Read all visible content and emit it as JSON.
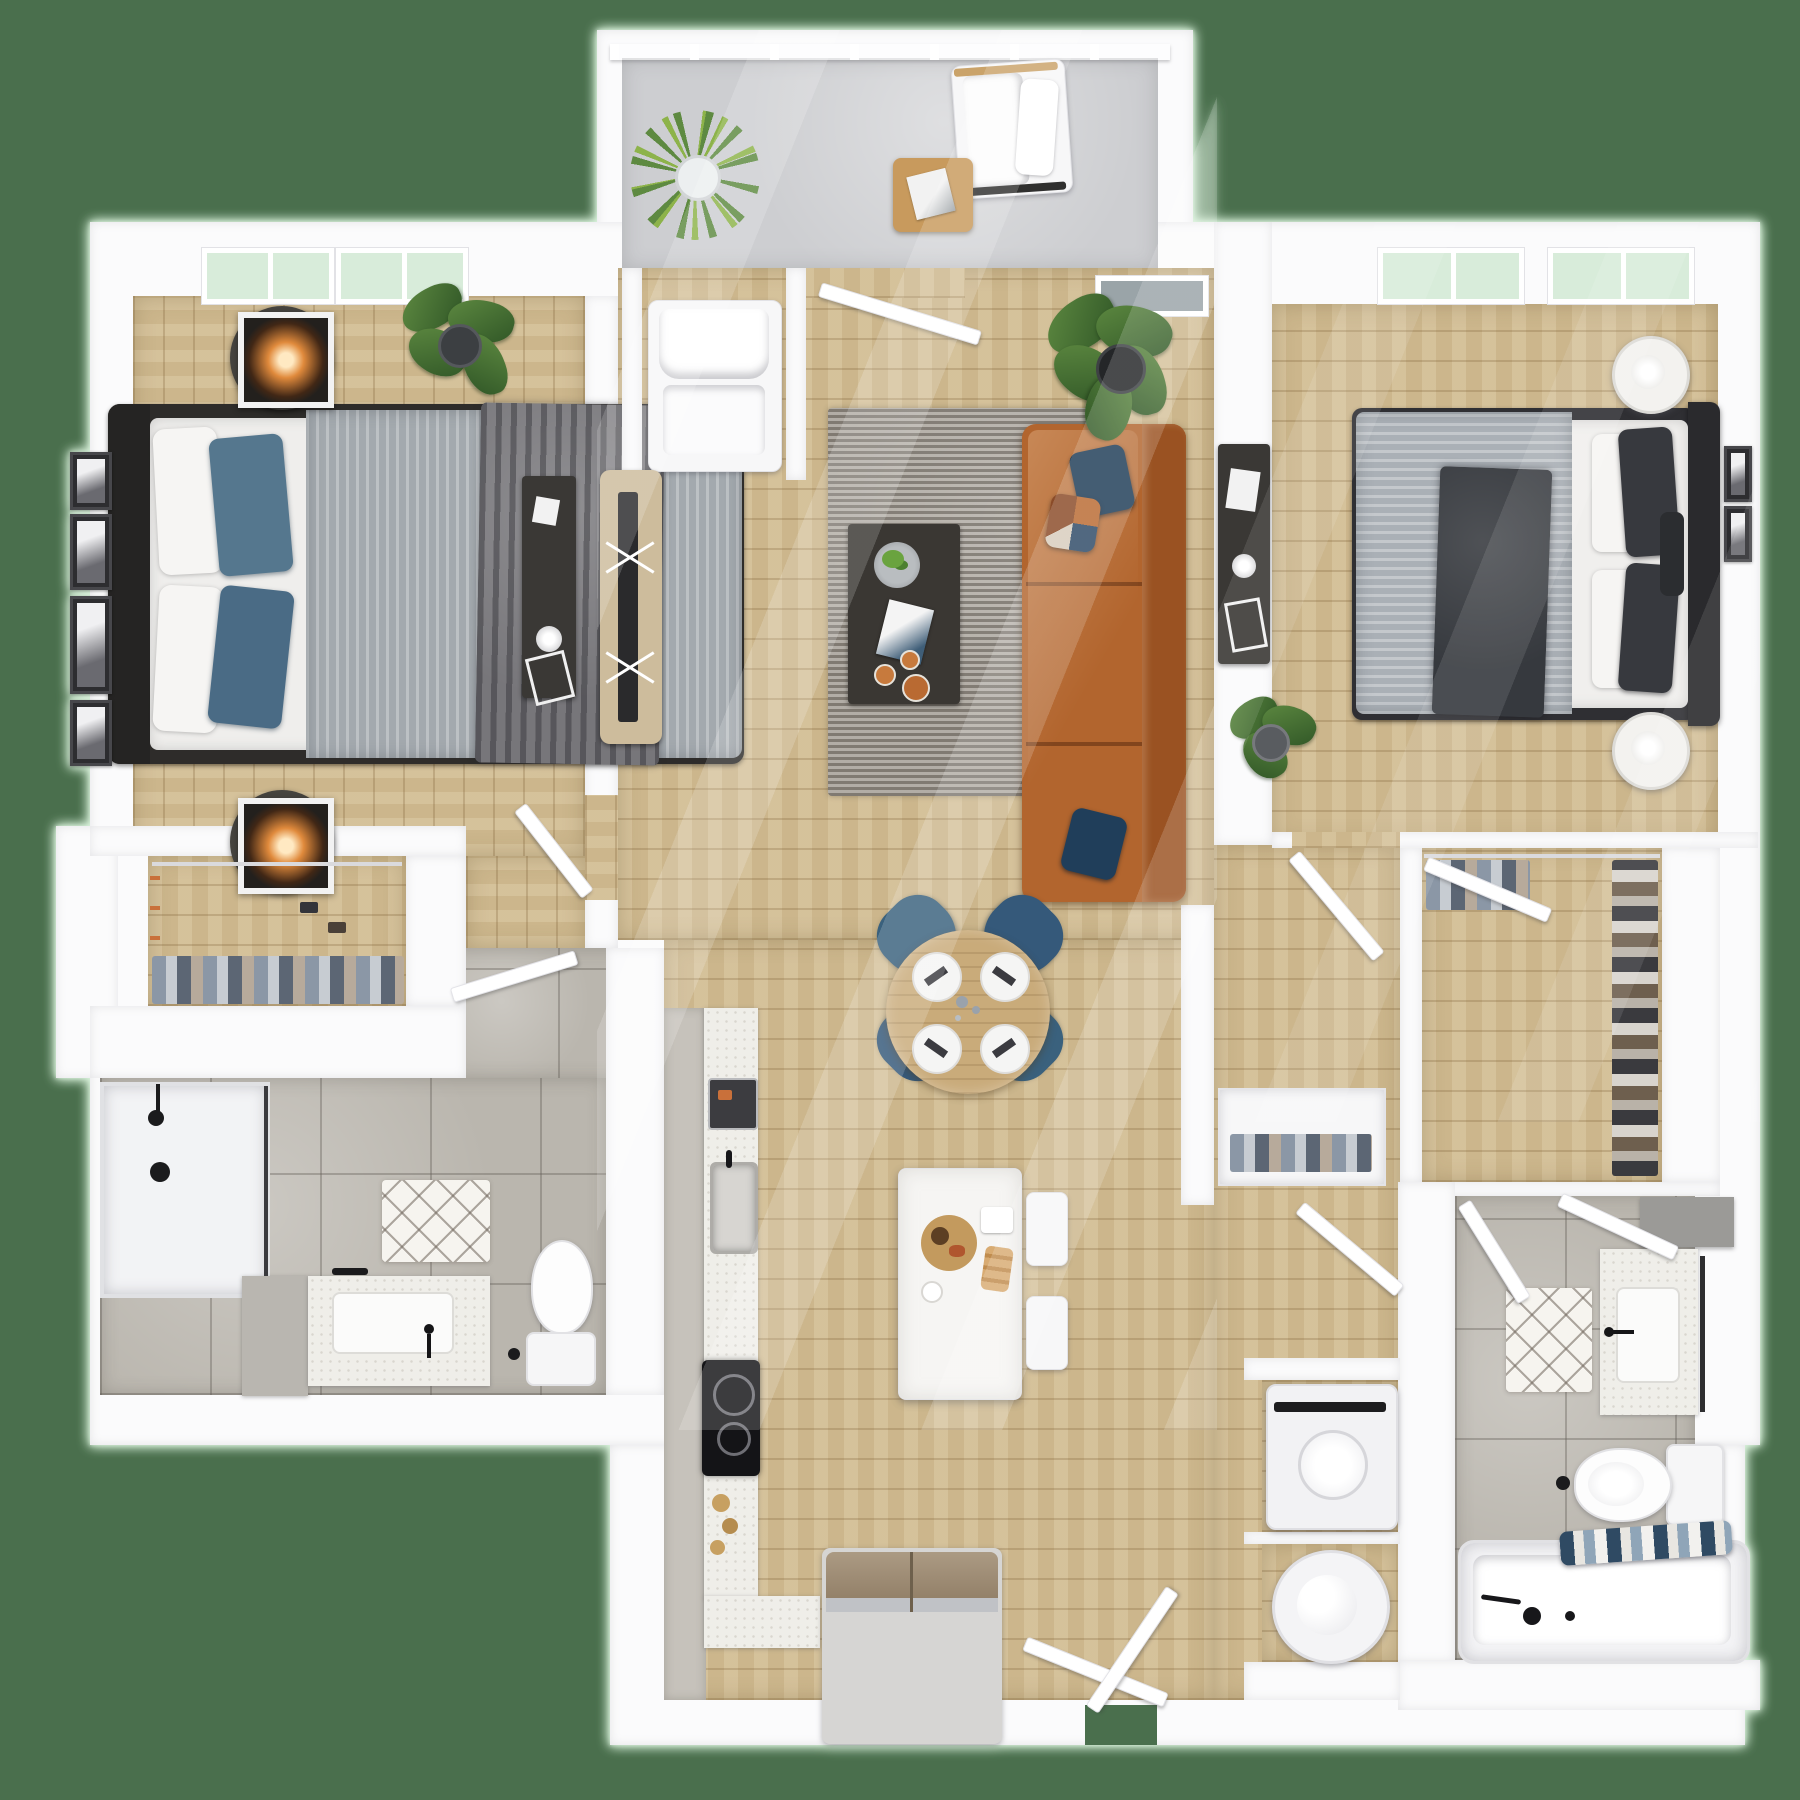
{
  "scene": {
    "kind": "3d-floor-plan-render",
    "view": "top-down",
    "description": "Two bedroom, two bathroom apartment floor plan with balcony",
    "visible_text": ""
  },
  "colors": {
    "bg": "#4a6f4d",
    "halo": "#d9f2db",
    "wall": "#fbfbfc",
    "woodA": "#d2bd93",
    "plank": "rgba(130,100,58,0.28)",
    "tile": "#bab6ae",
    "tileLine": "rgba(100,95,88,0.38)",
    "concrete": "#cdced1",
    "rug": "#a19b92",
    "sofa": "#b2652e",
    "sofaDark": "#9a5222",
    "navy": "#1e3c57",
    "tableWood": "#c9ab7a",
    "chairNavy": "#3a617d",
    "marble": "#efeee9",
    "grayFloor": "#c6c2bb",
    "dark": "#383633",
    "duvet": "#a3a9ae",
    "throw": "#77767a",
    "pillowBlue": "#55778e",
    "duvet2": "#aab0b6",
    "dark2": "#36393e",
    "headboard": "#2a2a2d",
    "lampGlow": "#e08a3c",
    "leaf": "#5e8a41",
    "leafDark": "#2f5526",
    "glassMint": "#d8ecda",
    "glassGray": "#9aa4a8",
    "steel": "#c0c2c6",
    "fridgeTan": "#ab9a83"
  },
  "rooms": {
    "balcony": {
      "label": "Balcony",
      "furniture": [
        "spiky-plant",
        "lounge-chair",
        "side-table"
      ]
    },
    "bedroom1": {
      "label": "Bedroom 1",
      "furniture": [
        "queen-bed-blue",
        "nightstand-lamp x2",
        "wall-frames",
        "monstera-plant",
        "desk"
      ]
    },
    "living": {
      "label": "Living Room",
      "furniture": [
        "accent-chair",
        "tv-console",
        "leather-sofa",
        "coffee-table",
        "area-rug",
        "ficus-plant"
      ]
    },
    "dining": {
      "label": "Dining Area",
      "furniture": [
        "round-table",
        "navy-chairs x4",
        "place-settings x4"
      ]
    },
    "kitchen": {
      "label": "Kitchen",
      "furniture": [
        "counter-run",
        "sink",
        "cooktop",
        "refrigerator",
        "island",
        "stools x2"
      ]
    },
    "bedroom2": {
      "label": "Bedroom 2",
      "furniture": [
        "queen-bed-gray",
        "drum-lamp x2",
        "desk",
        "plant",
        "wall-frames"
      ]
    },
    "closet1": {
      "label": "Walk-in Closet 1",
      "furniture": [
        "hanging-clothes",
        "shoes"
      ]
    },
    "closet2": {
      "label": "Walk-in Closet 2",
      "furniture": [
        "hanging-clothes",
        "shoe-rack"
      ]
    },
    "bath1": {
      "label": "Bathroom 1",
      "furniture": [
        "glass-shower",
        "vanity-sink",
        "toilet",
        "bath-mat"
      ]
    },
    "bath2": {
      "label": "Bathroom 2",
      "furniture": [
        "vanity-sink",
        "toilet",
        "bathtub-towels",
        "bath-mat"
      ]
    },
    "laundry": {
      "label": "Laundry Closet",
      "furniture": [
        "washer",
        "water-heater"
      ]
    },
    "hall": {
      "label": "Hallway",
      "furniture": [
        "linen-shelf"
      ]
    },
    "entry": {
      "label": "Entry",
      "furniture": [
        "front-door"
      ]
    }
  }
}
